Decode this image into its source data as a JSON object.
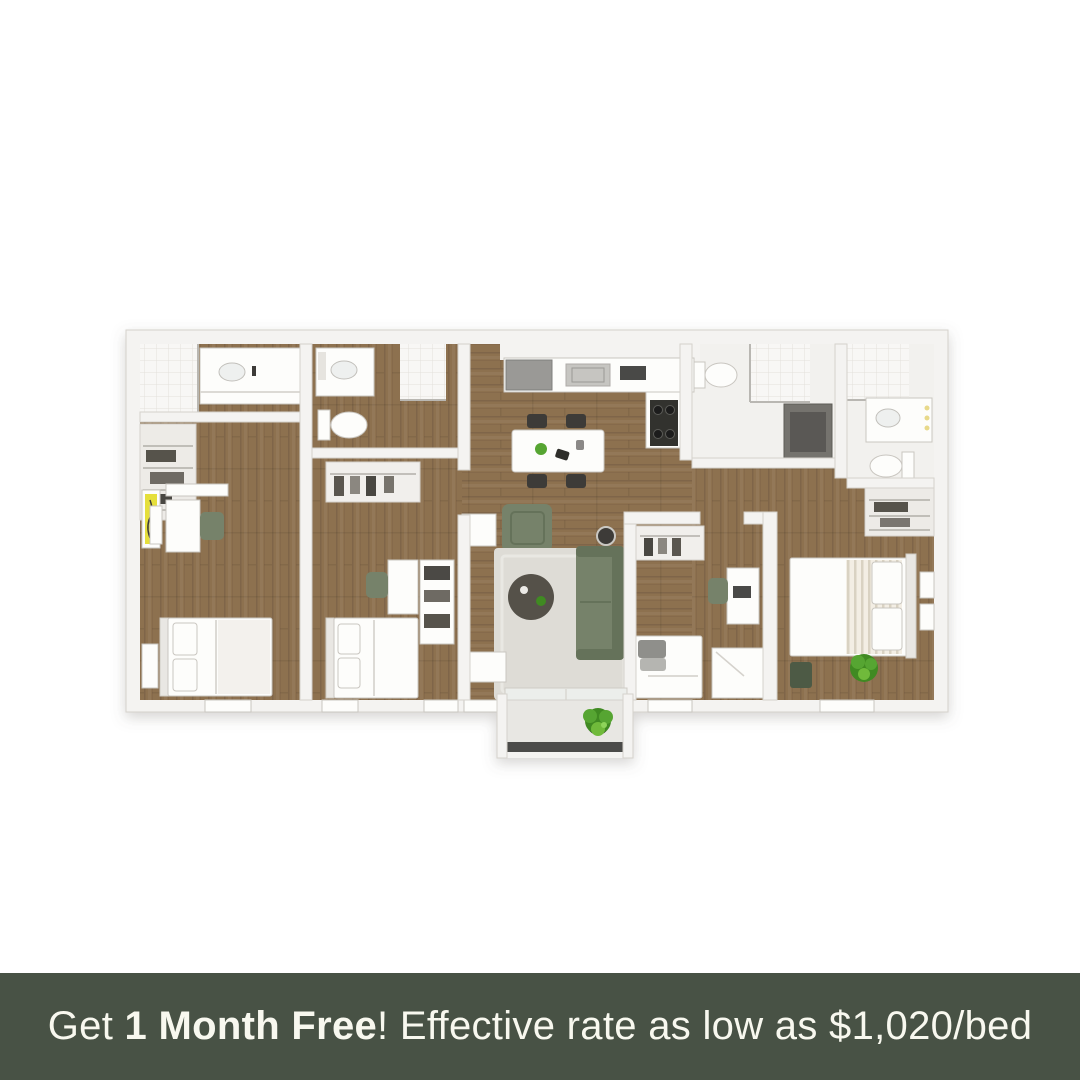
{
  "promo_banner": {
    "text_prefix": "Get ",
    "text_bold": "1 Month Free",
    "text_suffix": "! Effective rate as low as $1,020/bed"
  },
  "colors": {
    "banner-bg": "#485245",
    "banner-text": "#f8f8ef",
    "page-bg": "#ffffff",
    "wood": "#8d7150",
    "wood-light": "#977c5b",
    "wall": "#f4f3f1",
    "wall-stroke": "#d5d2cc",
    "tile": "#f8f7f5",
    "rug": "#dedcd6",
    "sofa-green": "#76826a",
    "sofa-green-dark": "#65725a",
    "plant-green": "#57a530",
    "plant-green-dark": "#3f8a22",
    "dark-gray": "#3c3b37",
    "appliance-gray": "#74736e",
    "accent-yellow": "#e5df3a",
    "table-dark": "#55514a",
    "balcony-rail": "#4c4c48"
  }
}
